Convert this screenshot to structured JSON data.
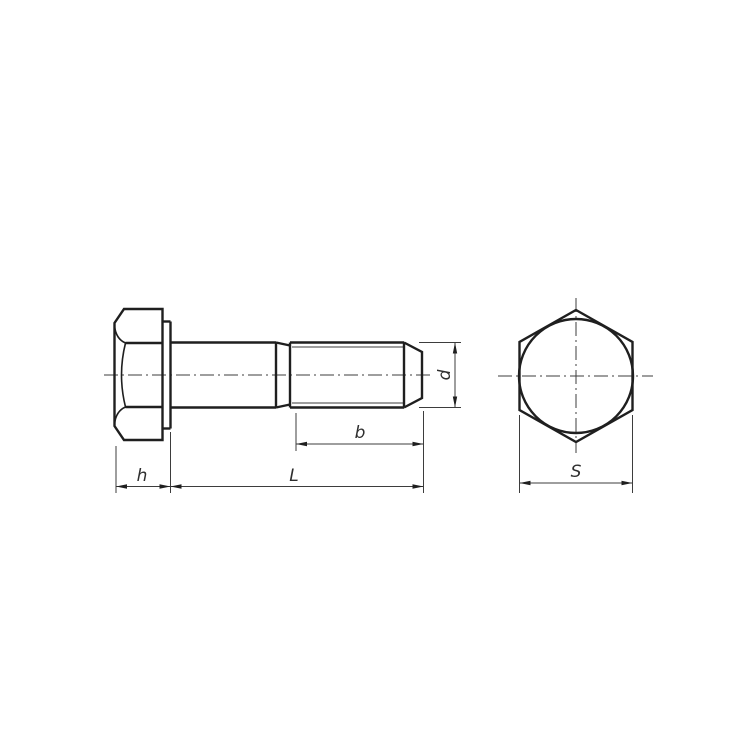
{
  "drawing": {
    "labels": {
      "head_height": "h",
      "total_length": "L",
      "thread_length": "b",
      "thread_diameter": "d",
      "width_across_flats": "S"
    },
    "colors": {
      "outline": "#1f1f1f",
      "thin_line": "#3d3d3d",
      "background": "#ffffff"
    }
  }
}
